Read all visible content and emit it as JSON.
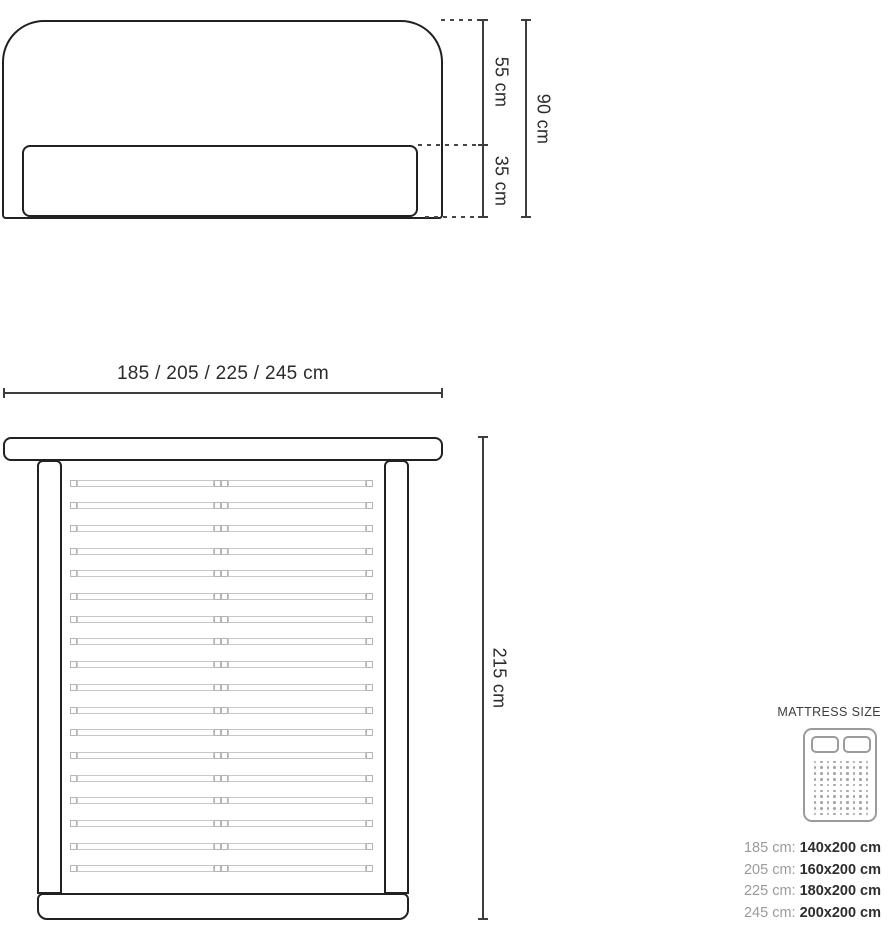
{
  "front_view": {
    "upper_height_label": "55 cm",
    "lower_height_label": "35 cm",
    "total_height_label": "90 cm"
  },
  "top_view": {
    "width_label": "185 / 205 / 225 / 245 cm",
    "length_label": "215 cm",
    "slat_count": 18
  },
  "legend": {
    "title": "MATTRESS SIZE",
    "icon": {
      "dot_cols": 9,
      "dot_rows": 10
    },
    "rows": [
      {
        "frame": "185 cm:",
        "mattress": "140x200 cm"
      },
      {
        "frame": "205 cm:",
        "mattress": "160x200 cm"
      },
      {
        "frame": "225 cm:",
        "mattress": "180x200 cm"
      },
      {
        "frame": "245 cm:",
        "mattress": "200x200 cm"
      }
    ]
  },
  "colors": {
    "outline": "#212121",
    "dimension_line": "#3d3d3d",
    "slat": "#c7c7c7",
    "muted_text": "#9a9a9b",
    "dark_text": "#2e2e30"
  }
}
